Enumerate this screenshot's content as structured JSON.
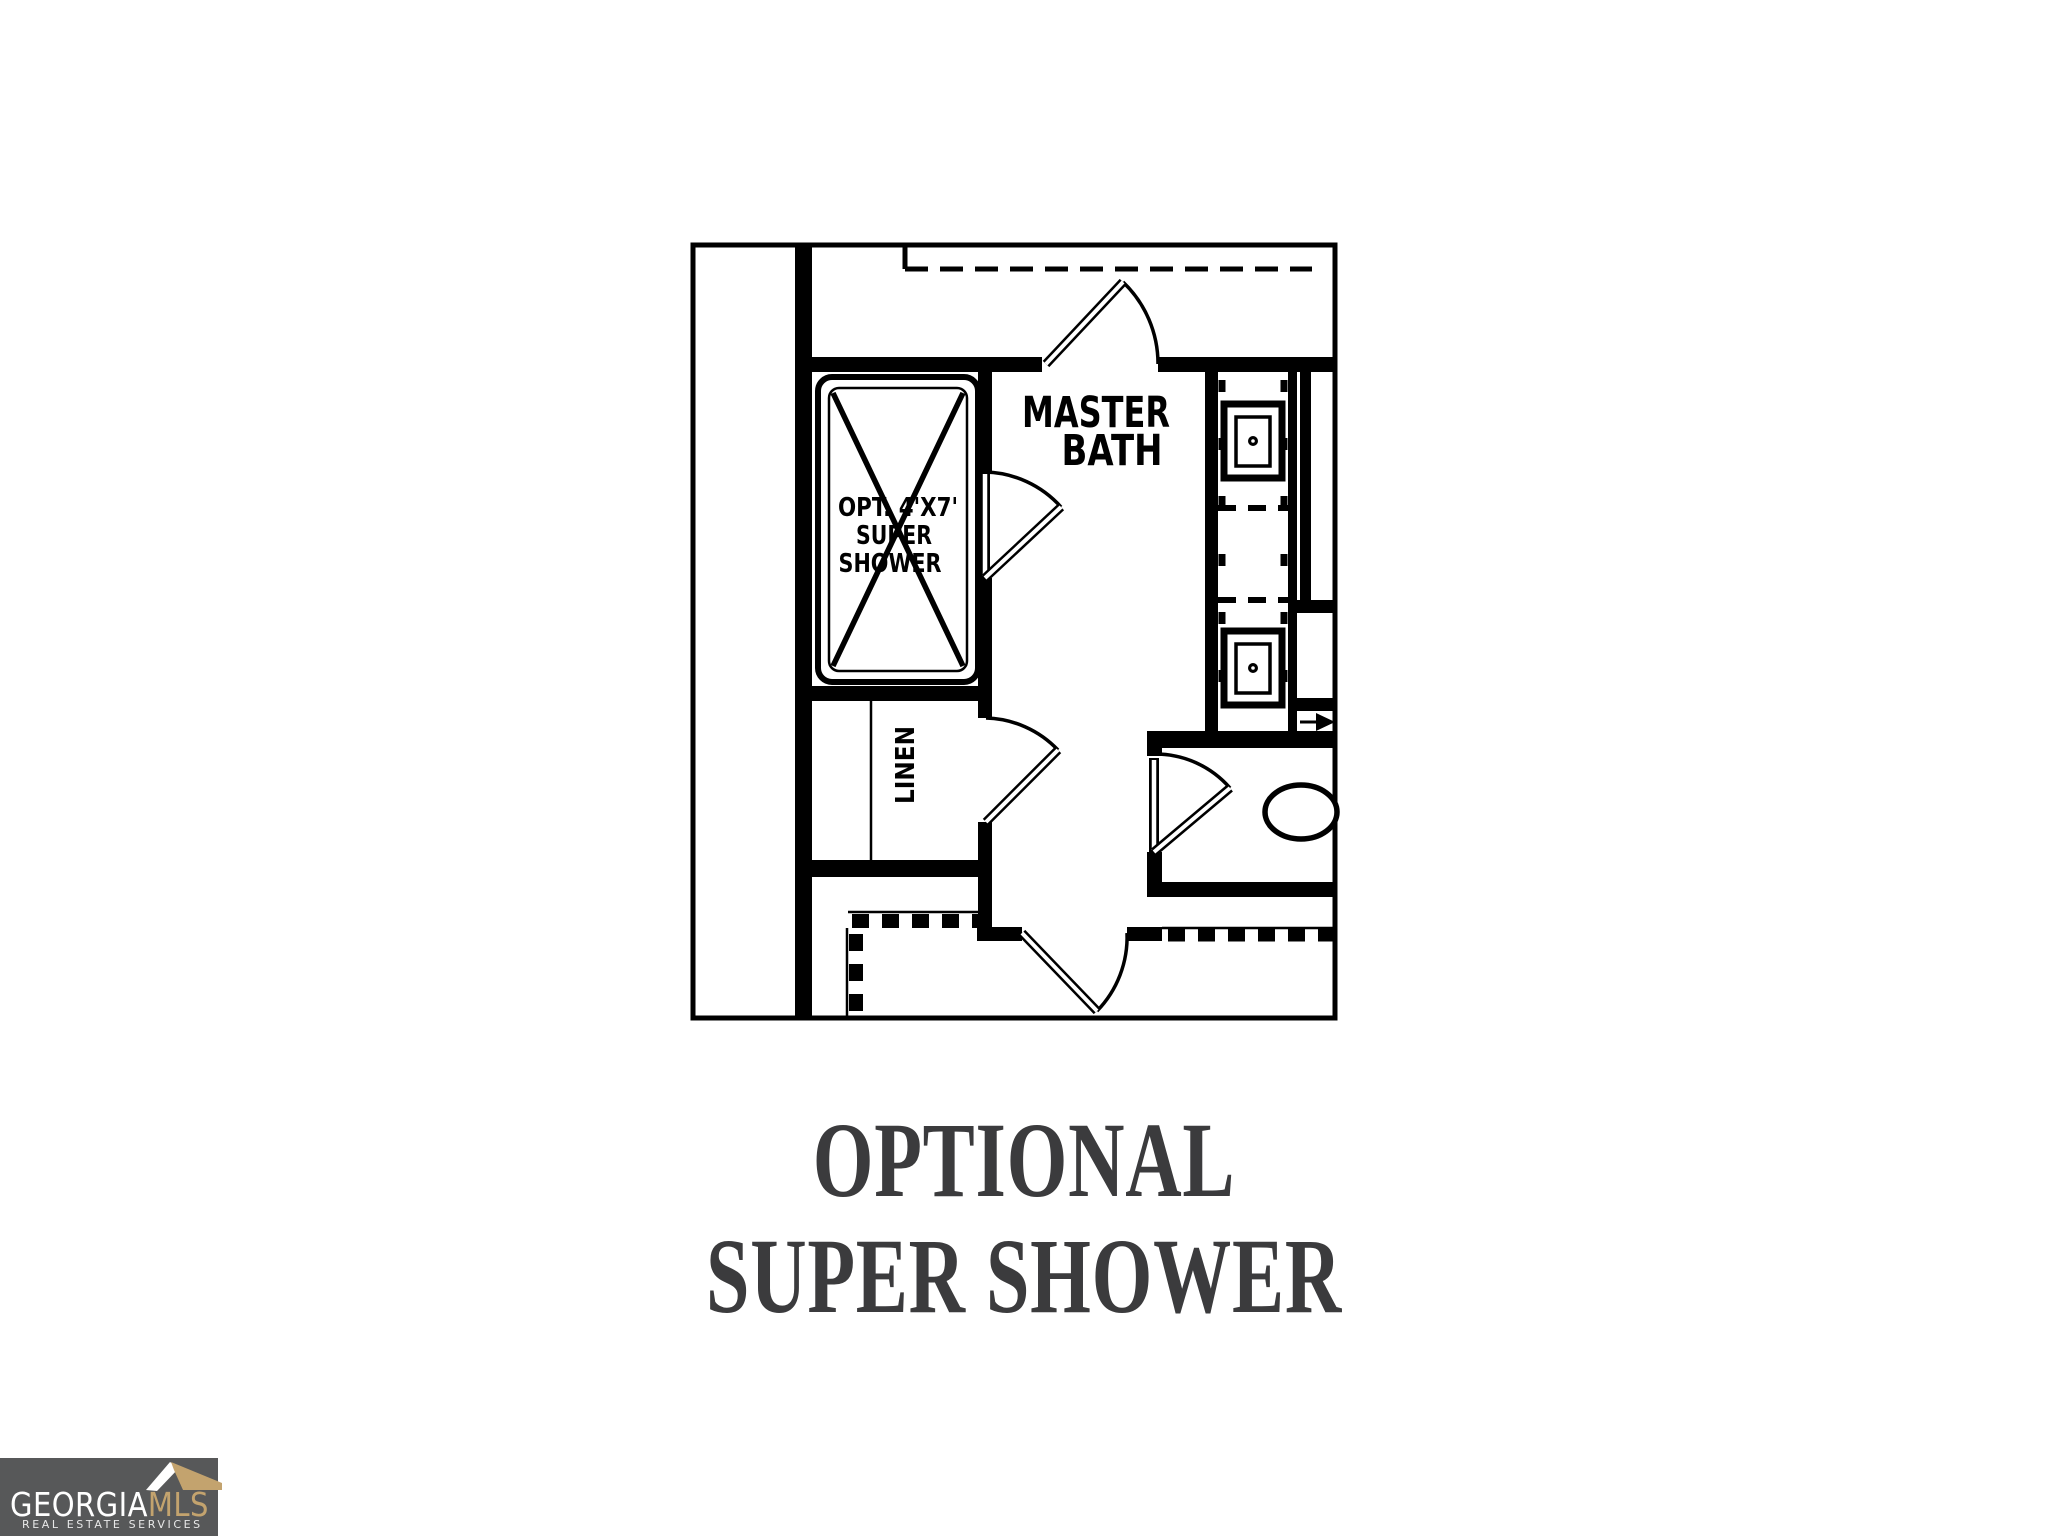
{
  "page": {
    "background_color": "#ffffff"
  },
  "floor_plan": {
    "line_color": "#000000",
    "labels": {
      "room_line1": "MASTER",
      "room_line2": "BATH",
      "shower_line1": "OPT. 4'X7'",
      "shower_line2": "SUPER",
      "shower_line3": "SHOWER",
      "closet": "LINEN"
    }
  },
  "caption": {
    "line1": "OPTIONAL",
    "line2": "SUPER SHOWER",
    "text_color": "#3b3b3d"
  },
  "logo": {
    "brand_part1": "GEORGIA",
    "brand_part2": "MLS",
    "tagline": "REAL ESTATE SERVICES",
    "background_color": "#575859",
    "brand_part1_color": "#ffffff",
    "brand_part2_color": "#c3a36e",
    "tagline_color": "#e8e8e8"
  }
}
